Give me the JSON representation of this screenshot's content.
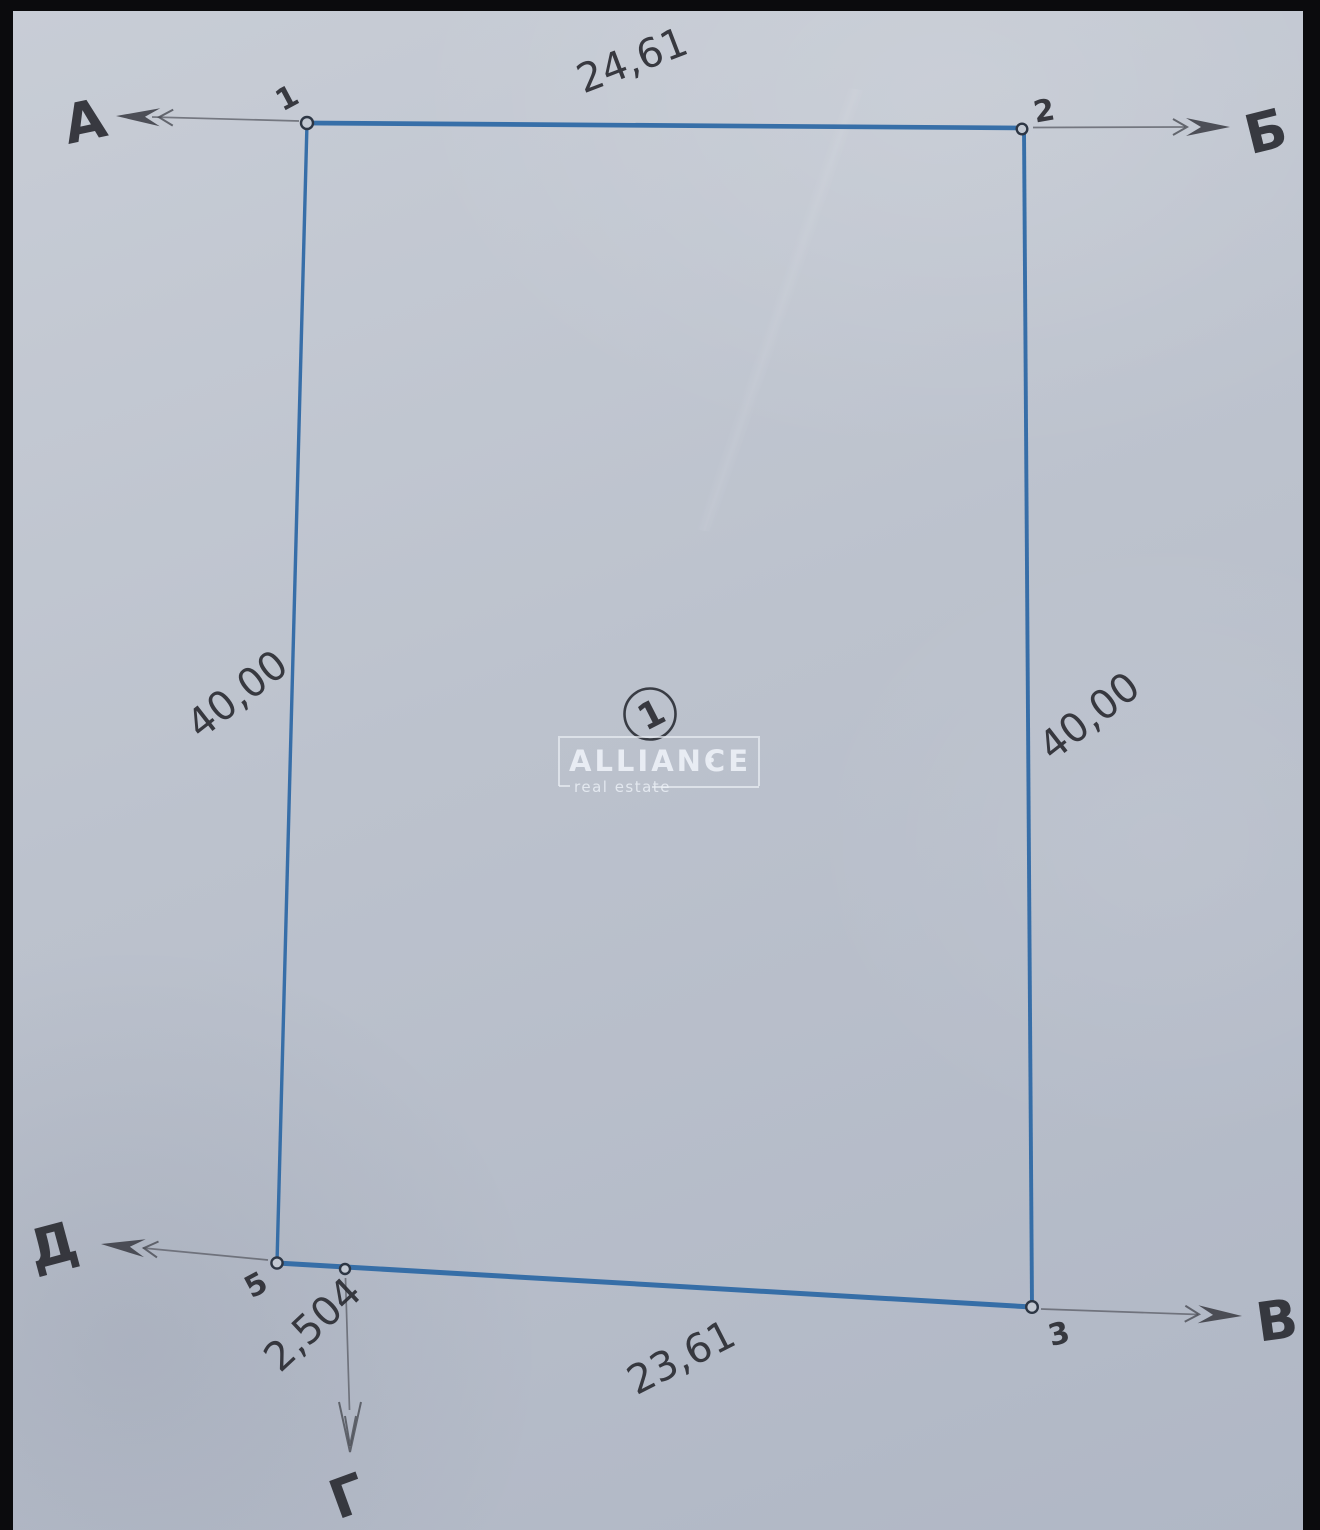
{
  "parcel": {
    "number": "1"
  },
  "dimensions": {
    "top": "24,61",
    "bottom": "23,61",
    "left": "40,00",
    "right": "40,00",
    "offset": "2,504"
  },
  "points": {
    "p1": "1",
    "p2": "2",
    "p3": "3",
    "p5": "5"
  },
  "directions": {
    "a": "А",
    "b": "Б",
    "v": "В",
    "g": "Г",
    "d": "Д"
  },
  "watermark": {
    "brand": "ALLIANCE",
    "tagline": "real estate"
  },
  "colors": {
    "boundary_blue": "#2f69a5",
    "ink": "#2b2c33",
    "arrow_gray": "#4a4c54",
    "paper": "#bcc2cd",
    "frame_black": "#0b0b0d",
    "watermark_white": "#ecf0f6"
  }
}
